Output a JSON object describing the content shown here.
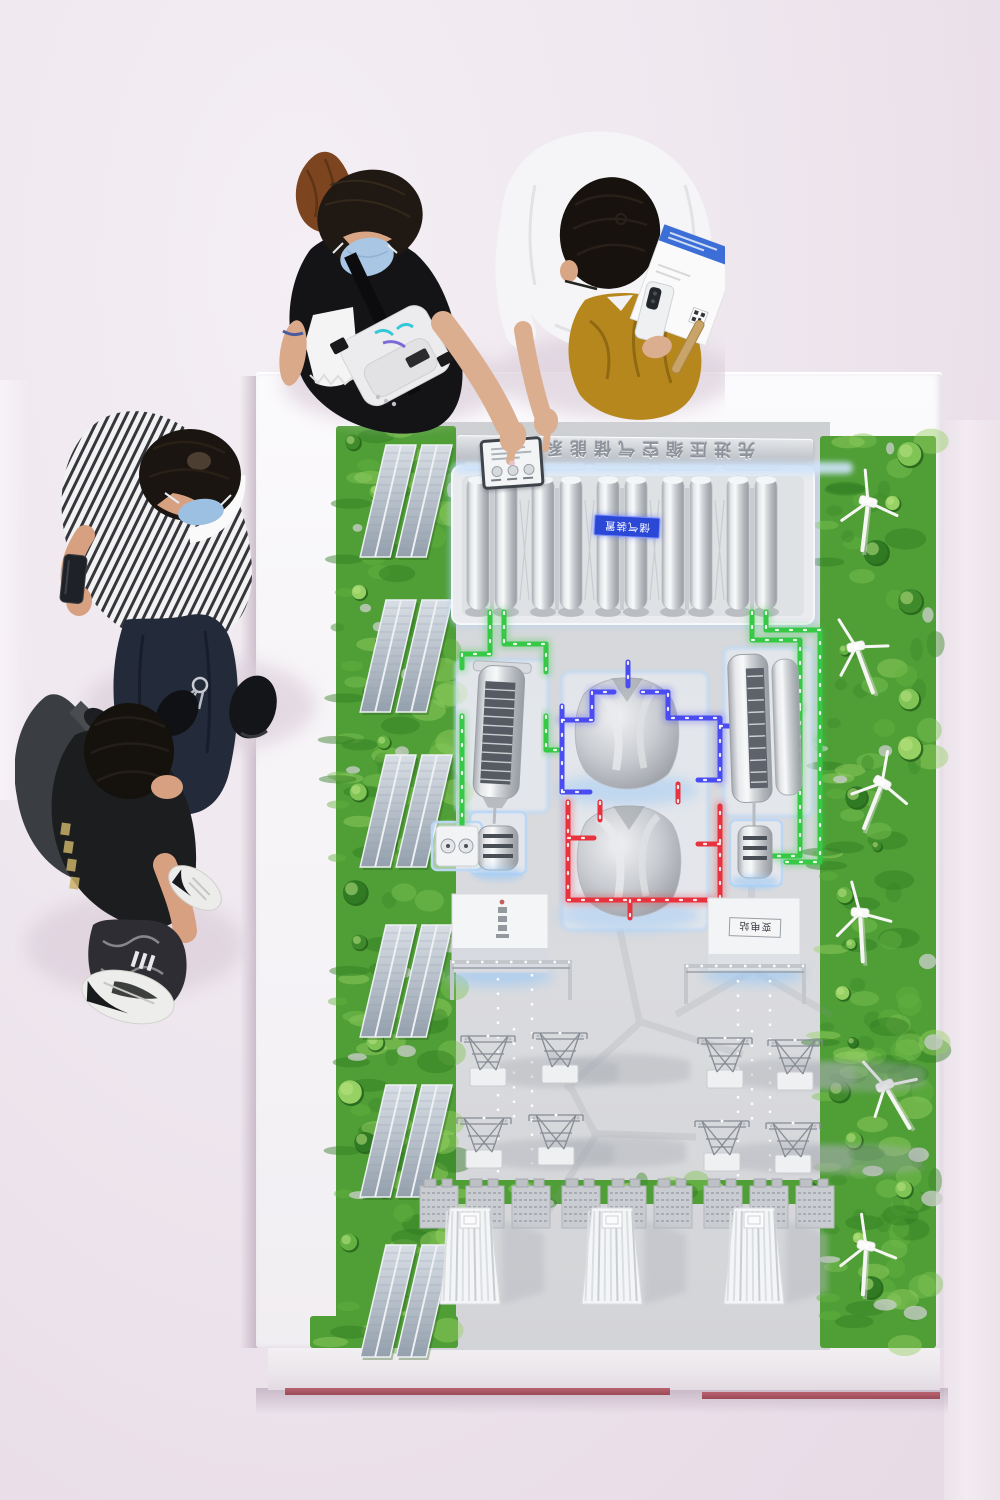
{
  "model": {
    "banner_text": "先进压缩空气储能系统",
    "gas_storage_label": "储气装置",
    "substation_label": "变电站",
    "colors": {
      "led_green": "#36c945",
      "led_blue": "#4a4cf2",
      "led_red": "#e8333e",
      "platform_glow": "#aed2f6",
      "grass_green": "#4f9e36",
      "floor_pink": "#eee6ed",
      "table_white": "#f7f5f8",
      "baseboard_maroon": "#a85562",
      "mustard_jacket": "#b6871d",
      "mask_blue": "#a9c6e4"
    }
  }
}
